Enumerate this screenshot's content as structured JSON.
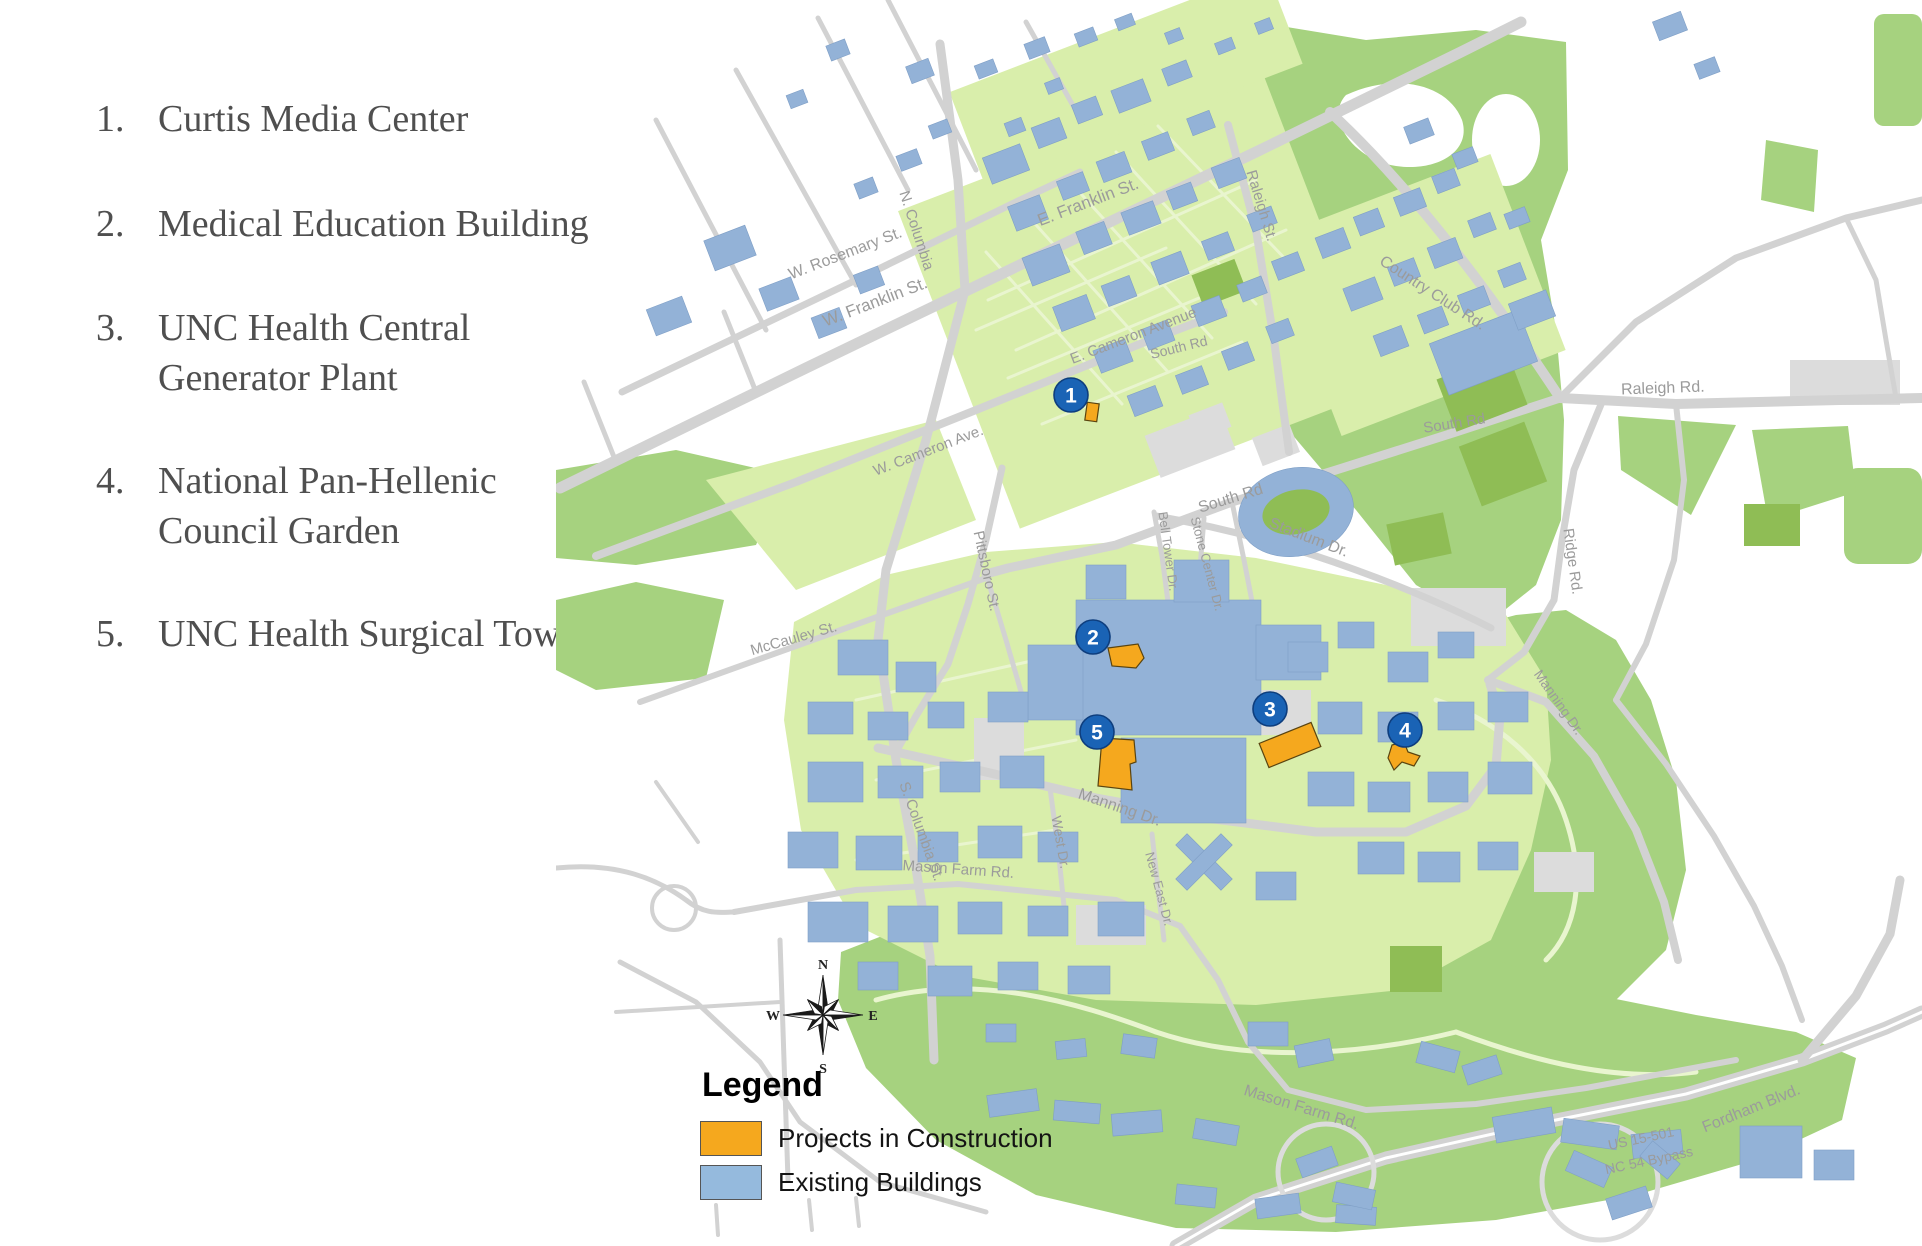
{
  "project_list": {
    "items": [
      {
        "number": "1.",
        "lines": [
          "Curtis Media Center"
        ]
      },
      {
        "number": "2.",
        "lines": [
          "Medical Education Building"
        ]
      },
      {
        "number": "3.",
        "lines": [
          "UNC Health Central",
          "Generator Plant"
        ]
      },
      {
        "number": "4.",
        "lines": [
          "National Pan-Hellenic",
          "Council Garden"
        ]
      },
      {
        "number": "5.",
        "lines": [
          "UNC Health Surgical Tower"
        ]
      }
    ]
  },
  "map": {
    "legend": {
      "title": "Legend",
      "items": [
        {
          "label": "Projects in Construction",
          "color": "#F5A81E"
        },
        {
          "label": "Existing Buildings",
          "color": "#95BADD"
        }
      ]
    },
    "compass": {
      "north": "N",
      "south": "S",
      "east": "E",
      "west": "W"
    },
    "markers": [
      {
        "number": "1",
        "x": 515,
        "y": 395
      },
      {
        "number": "2",
        "x": 537,
        "y": 637
      },
      {
        "number": "3",
        "x": 714,
        "y": 709
      },
      {
        "number": "4",
        "x": 849,
        "y": 730
      },
      {
        "number": "5",
        "x": 541,
        "y": 732
      }
    ],
    "road_labels": [
      {
        "text": "W. Rosemary St.",
        "x": 291,
        "y": 258,
        "rot": -21,
        "size": 16
      },
      {
        "text": "N. Columbia",
        "x": 356,
        "y": 232,
        "rot": 72,
        "size": 15
      },
      {
        "text": "W. Franklin St.",
        "x": 321,
        "y": 307,
        "rot": -21,
        "size": 17
      },
      {
        "text": "E. Franklin St.",
        "x": 534,
        "y": 207,
        "rot": -21,
        "size": 17
      },
      {
        "text": "Raleigh St.",
        "x": 701,
        "y": 207,
        "rot": 73,
        "size": 15
      },
      {
        "text": "Country Club Rd.",
        "x": 874,
        "y": 297,
        "rot": 33,
        "size": 16
      },
      {
        "text": "E. Cameron Avenue",
        "x": 579,
        "y": 340,
        "rot": -21,
        "size": 15
      },
      {
        "text": "W. Cameron Ave.",
        "x": 374,
        "y": 455,
        "rot": -21,
        "size": 15
      },
      {
        "text": "South Rd",
        "x": 624,
        "y": 352,
        "rot": -14,
        "size": 14
      },
      {
        "text": "Raleigh Rd.",
        "x": 1107,
        "y": 393,
        "rot": -2,
        "size": 16
      },
      {
        "text": "South Rd",
        "x": 899,
        "y": 428,
        "rot": -9,
        "size": 15
      },
      {
        "text": "South Rd",
        "x": 676,
        "y": 503,
        "rot": -17,
        "size": 16
      },
      {
        "text": "Stadium Dr.",
        "x": 751,
        "y": 542,
        "rot": 21,
        "size": 16
      },
      {
        "text": "Bell Tower Dr.",
        "x": 608,
        "y": 552,
        "rot": 82,
        "size": 13
      },
      {
        "text": "Stone Center Dr.",
        "x": 647,
        "y": 565,
        "rot": 75,
        "size": 13
      },
      {
        "text": "Ridge Rd.",
        "x": 1012,
        "y": 562,
        "rot": 82,
        "size": 15
      },
      {
        "text": "Pittsboro St.",
        "x": 426,
        "y": 572,
        "rot": 78,
        "size": 15
      },
      {
        "text": "McCauley St.",
        "x": 239,
        "y": 643,
        "rot": -16,
        "size": 15
      },
      {
        "text": "S. Columbia St.",
        "x": 361,
        "y": 833,
        "rot": 70,
        "size": 15
      },
      {
        "text": "West Dr.",
        "x": 500,
        "y": 843,
        "rot": 80,
        "size": 14
      },
      {
        "text": "Manning Dr.",
        "x": 562,
        "y": 812,
        "rot": 19,
        "size": 16
      },
      {
        "text": "Manning Dr.",
        "x": 999,
        "y": 705,
        "rot": 55,
        "size": 14
      },
      {
        "text": "Mason Farm Rd.",
        "x": 402,
        "y": 874,
        "rot": 4,
        "size": 15
      },
      {
        "text": "New East Dr.",
        "x": 599,
        "y": 890,
        "rot": 75,
        "size": 13
      },
      {
        "text": "Mason Farm Rd.",
        "x": 744,
        "y": 1112,
        "rot": 17,
        "size": 16
      },
      {
        "text": "US 15-501",
        "x": 1086,
        "y": 1143,
        "rot": -12,
        "size": 14
      },
      {
        "text": "NC 54 Bypass",
        "x": 1094,
        "y": 1165,
        "rot": -12,
        "size": 14
      },
      {
        "text": "Fordham Blvd.",
        "x": 1197,
        "y": 1113,
        "rot": -22,
        "size": 16
      }
    ],
    "colors": {
      "map_background": "#ffffff",
      "campus_green_light": "#d9eeab",
      "park_green": "#a6d27f",
      "field_green": "#8fbd55",
      "building_blue": "#93b2d7",
      "road_gray": "#d2d2d2",
      "parking_gray": "#dcdcdc",
      "construction_orange": "#F5A81E",
      "marker_blue": "#1A63B5",
      "road_label_gray": "#9b9b9b",
      "list_text": "#4f4f4f"
    }
  }
}
